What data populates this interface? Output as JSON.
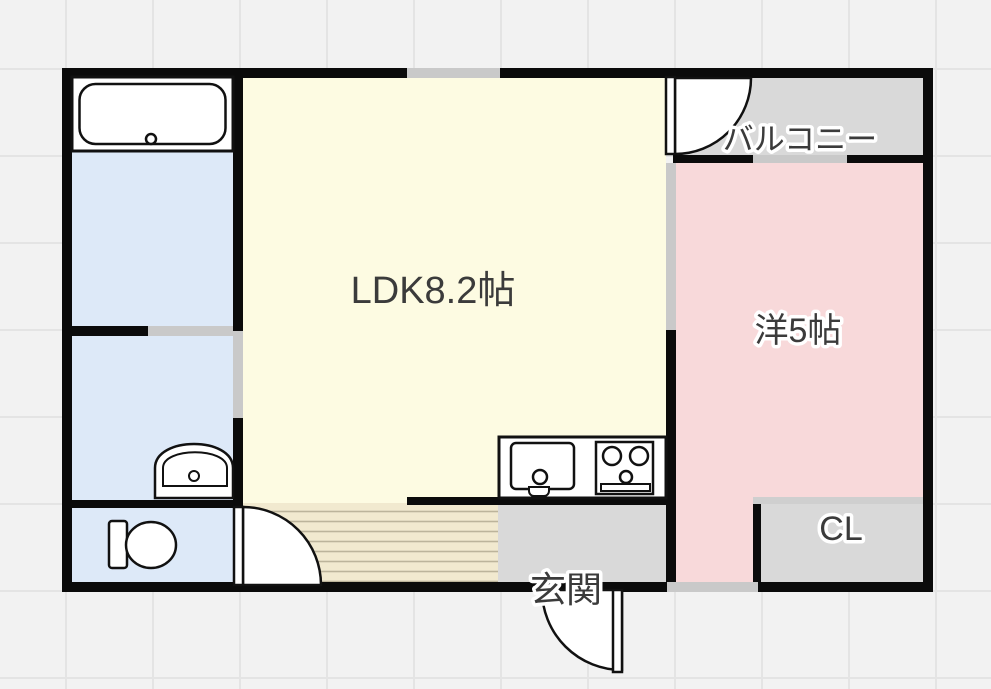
{
  "page": {
    "type": "apartment-floor-plan"
  },
  "rooms": {
    "ldk": {
      "label": "LDK8.2帖",
      "color": "#FDFBE2"
    },
    "western": {
      "label": "洋5帖",
      "color": "#F8D9DA"
    },
    "balcony": {
      "label": "バルコニー",
      "color": "#D9D9D9"
    },
    "closet": {
      "label": "CL",
      "color": "#D9D9D9"
    },
    "entrance": {
      "label": "玄関",
      "color": "#D9D9D9"
    },
    "bathroom": {
      "color": "#DDE9F8"
    },
    "washroom": {
      "color": "#DDE9F8"
    },
    "toilet": {
      "color": "#DDE9F8"
    }
  },
  "colors": {
    "wall": "#0b0b0b",
    "opening": "#c9c9c9",
    "closet_door": "#cfcfcf",
    "flooring_base": "#F1E9CF",
    "flooring_line": "#BCB49B",
    "fixture_fill": "#ffffff",
    "fixture_line": "#111111",
    "label_text": "#3b3b3b",
    "label_outline": "#ffffff",
    "background": "#f2f2f2",
    "grid_line": "#e4e4e4"
  },
  "fixtures": {
    "bathtub": "bathtub-icon",
    "washbasin": "washbasin-icon",
    "toilet": "toilet-icon",
    "kitchen_sink": "kitchen-sink-icon",
    "stove": "stove-icon",
    "doors": "door-swing-icon"
  }
}
